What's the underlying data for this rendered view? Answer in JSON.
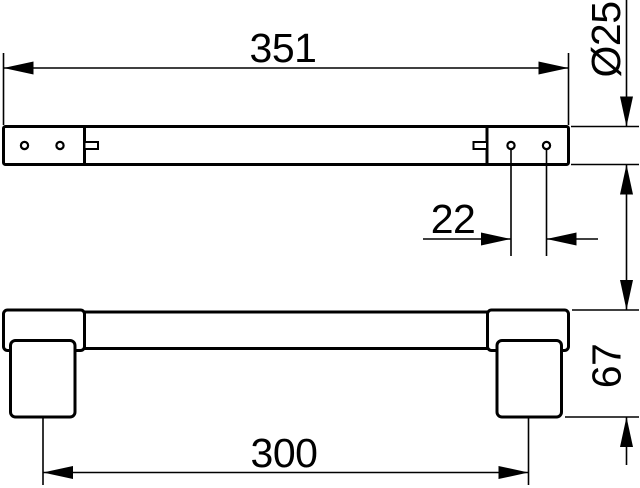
{
  "canvas": {
    "background": "#ffffff",
    "line_color": "#000000"
  },
  "drawing": {
    "kind": "technical-drawing-two-views",
    "dimensions": {
      "overall_length": "351",
      "bar_diameter": "Ø25",
      "hole_spacing": "22",
      "overall_height": "67",
      "mounting_centers": "300"
    }
  }
}
